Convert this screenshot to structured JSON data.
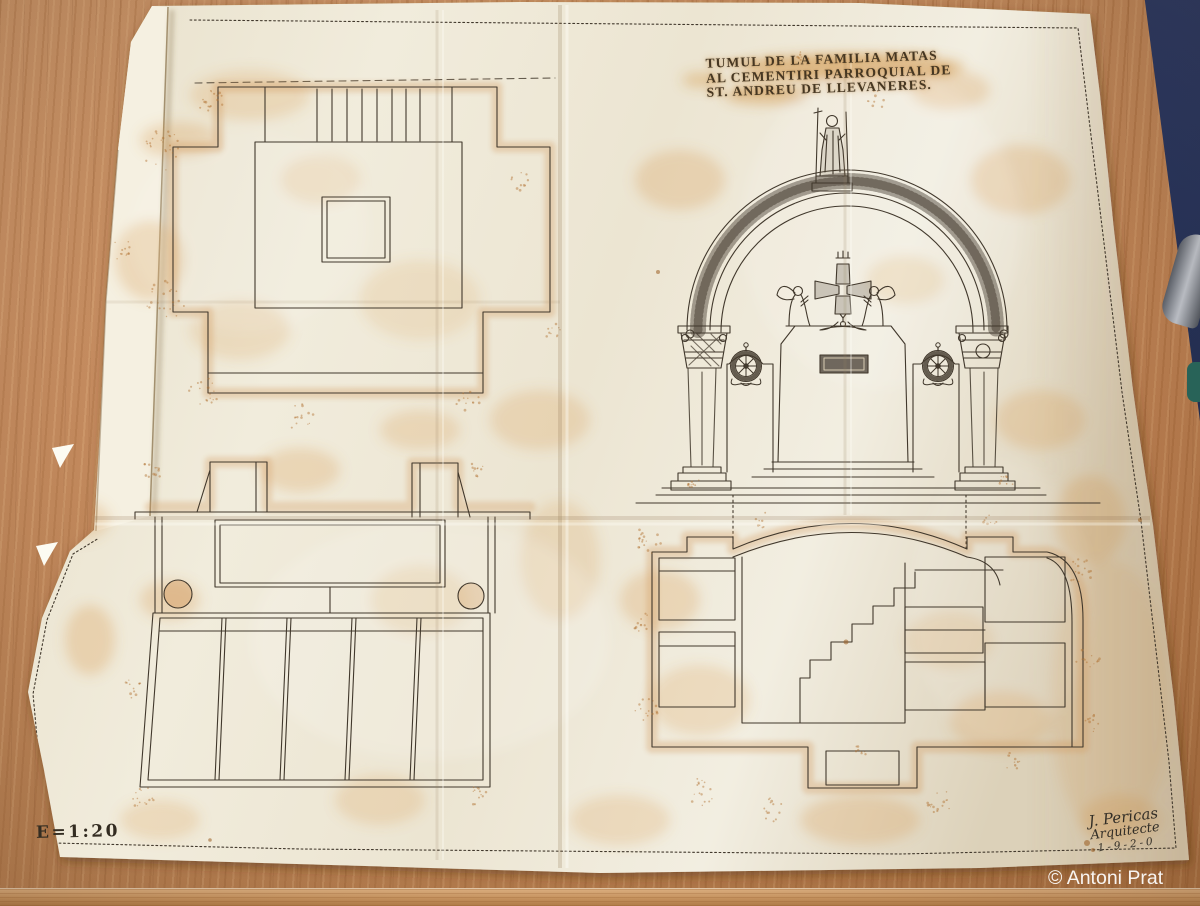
{
  "photo": {
    "description": "Aged architectural drawing on tracing paper lying on a wooden table",
    "credit": "© Antoni Prat"
  },
  "plan": {
    "title_lines": [
      "TUMUL DE LA FAMILIA MATAS",
      "AL CEMENTIRI PARROQUIAL DE",
      "ST. ANDREU DE LLEVANERES."
    ],
    "scale_label": "E=1:20",
    "signature": {
      "name": "J. Pericas",
      "role": "Arquitecte",
      "date": "1-9-2-0"
    }
  },
  "colors": {
    "wood": "#c28455",
    "floor": "#1a2444",
    "paper": "#efe8d6",
    "stain": "#d99a4e",
    "ink": "#41382c",
    "wash": "#d39a5e",
    "credit_text": "#ffffff"
  }
}
